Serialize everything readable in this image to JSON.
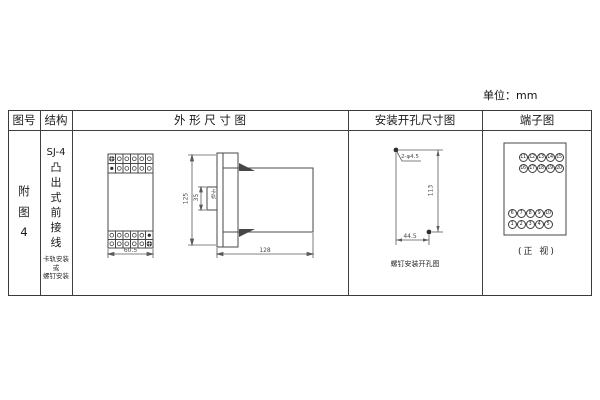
{
  "unit_label": "单位：mm",
  "table": {
    "headers": {
      "figure_no": "图号",
      "structure": "结构",
      "outline": "外 形 尺 寸 图",
      "mounting": "安装开孔尺寸图",
      "terminal": "端子图"
    }
  },
  "figure_cell": {
    "chars": [
      "附",
      "图",
      "4"
    ]
  },
  "structure_cell": {
    "model": "SJ-4",
    "type_chars": [
      "凸",
      "出",
      "式",
      "前",
      "接",
      "线"
    ],
    "mount_lines": [
      "卡轨安装",
      "或",
      "螺钉安装"
    ]
  },
  "outline_drawing": {
    "front_width": "60.5",
    "height": "125",
    "depth": "128",
    "rail_width": "35",
    "rail_label": "卡轨"
  },
  "mounting_drawing": {
    "hole_label": "2-φ4.5",
    "height": "113",
    "width": "44.5",
    "caption": "螺钉安装开孔图"
  },
  "terminal_diagram": {
    "numbers": [
      "11",
      "12",
      "13",
      "14",
      "15",
      "16",
      "17",
      "18",
      "19",
      "20",
      "6",
      "7",
      "8",
      "9",
      "10",
      "1",
      "2",
      "3",
      "4",
      "5"
    ],
    "caption": "(正 视)"
  }
}
